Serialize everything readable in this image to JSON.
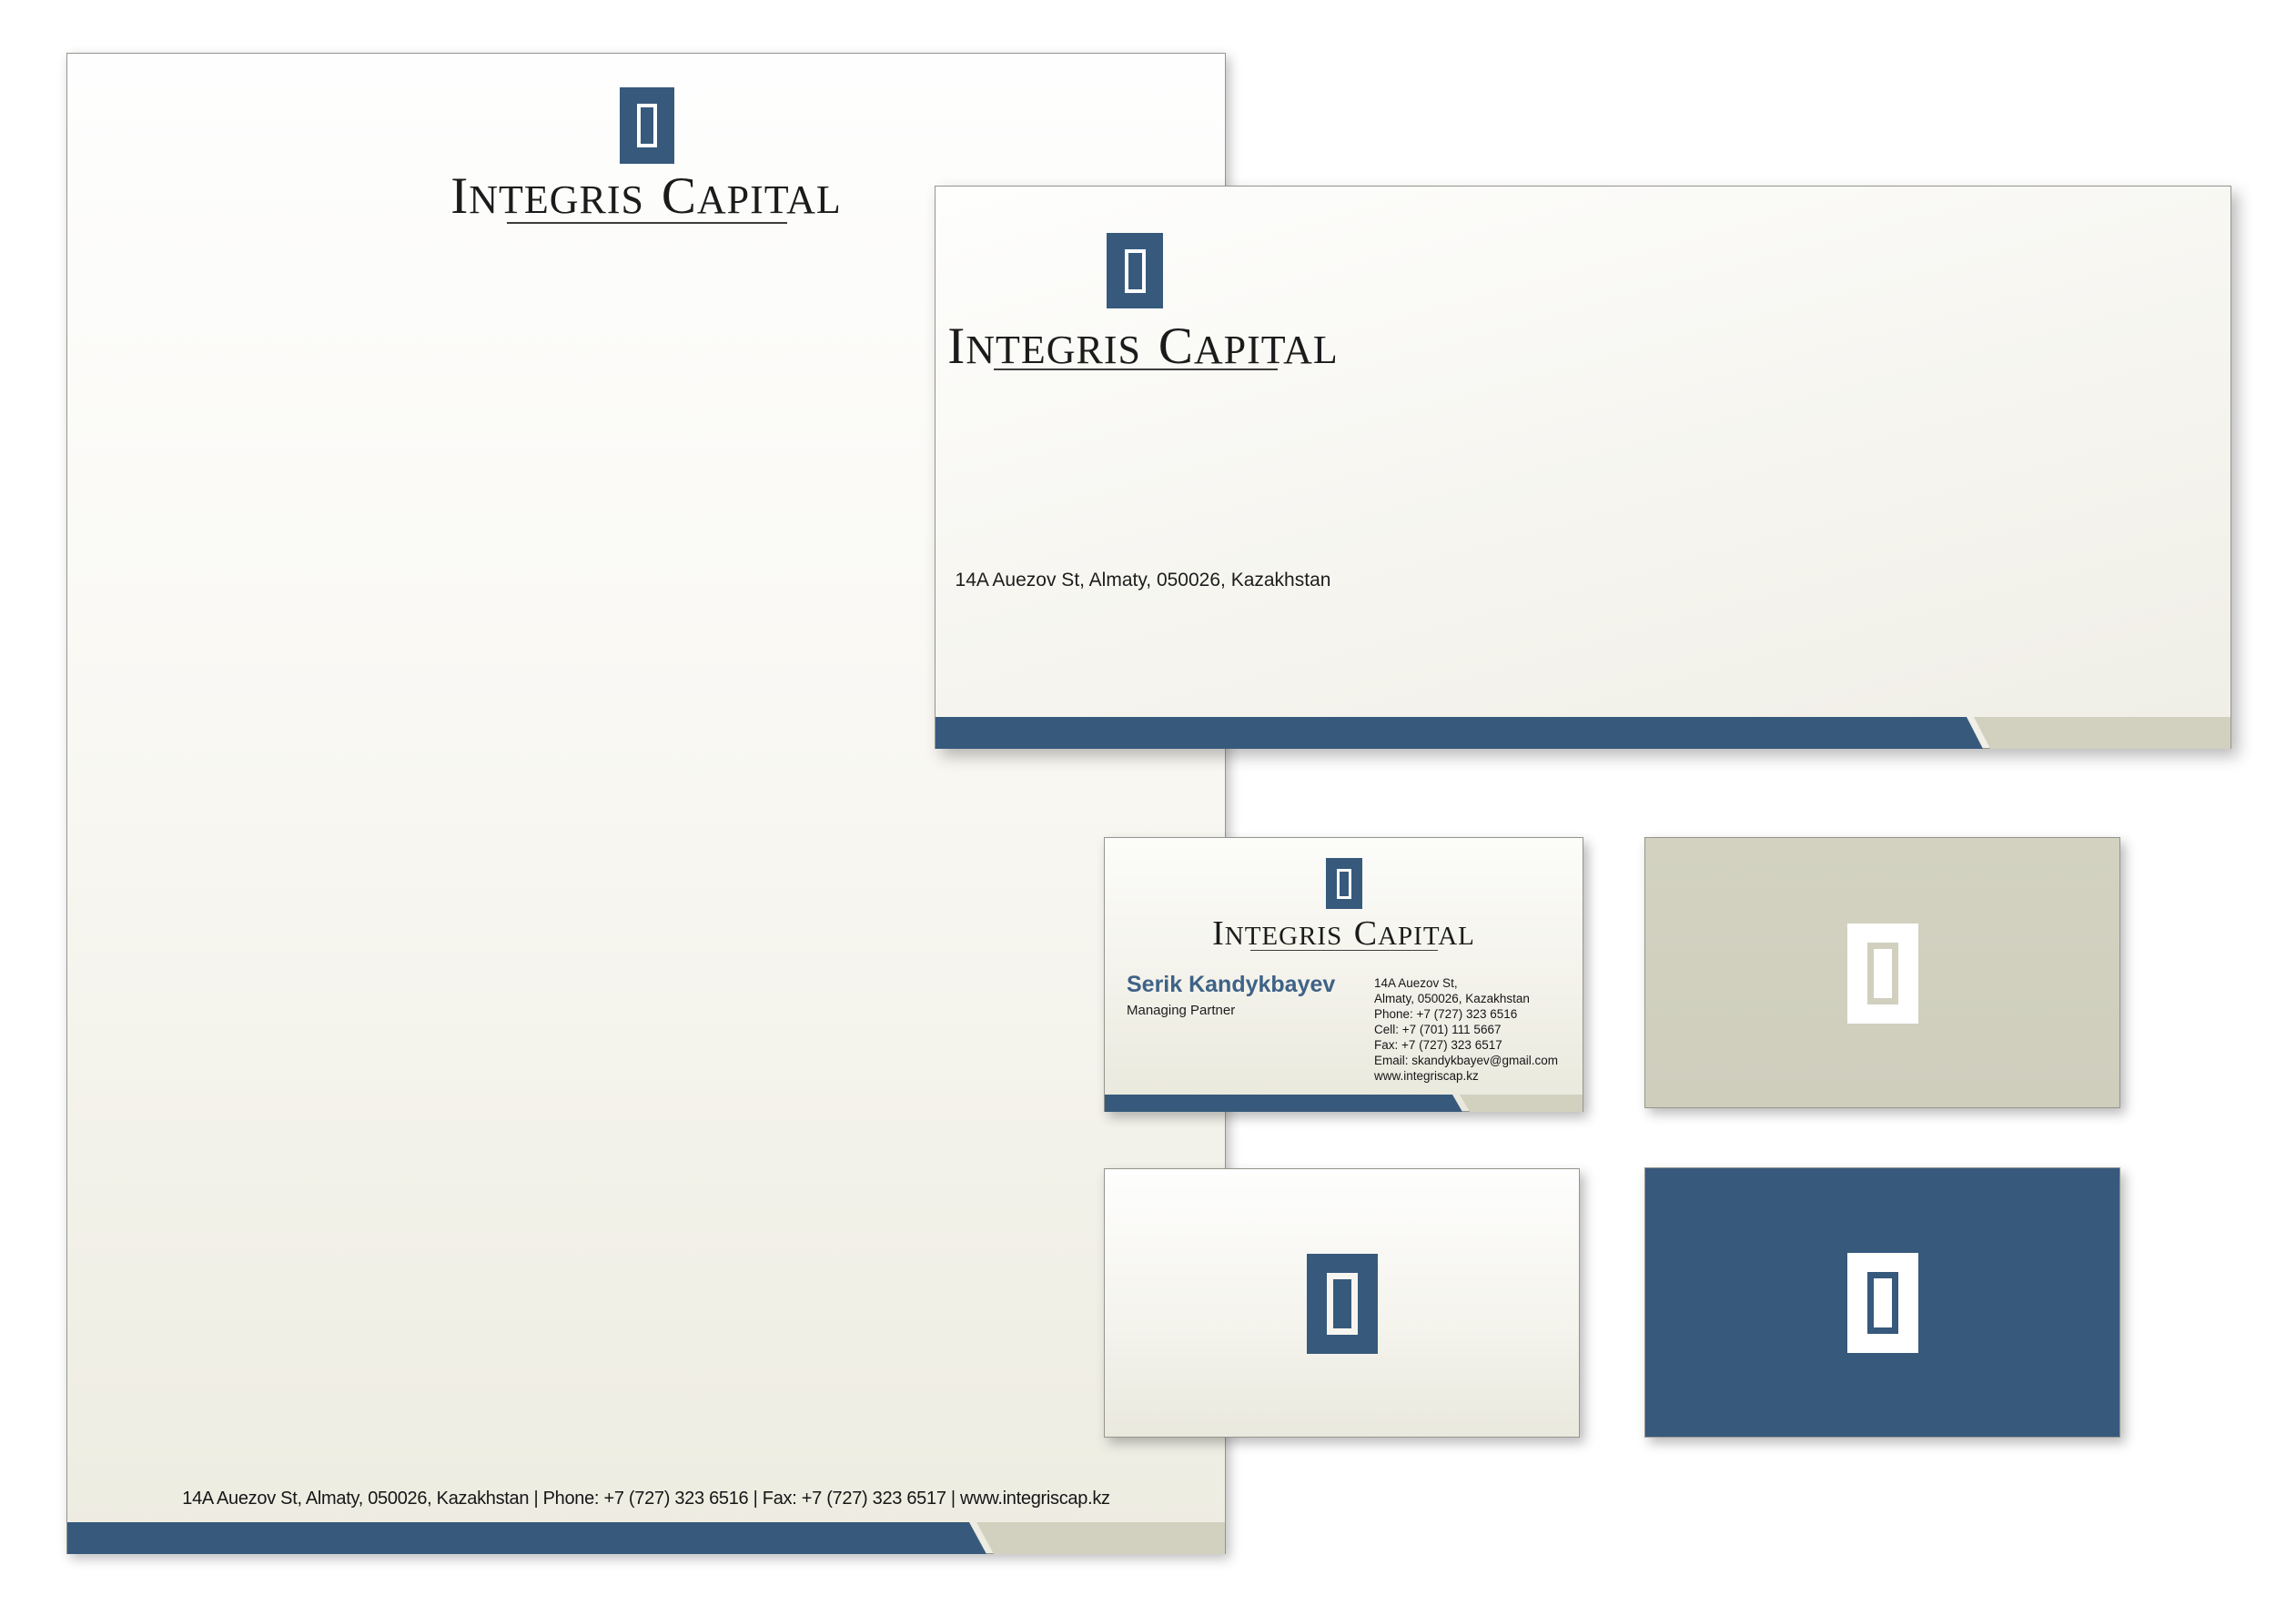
{
  "brand": {
    "name": "Integris Capital",
    "wordmark": {
      "w1i": "I",
      "w1r": "NTEGRIS",
      "w2i": "C",
      "w2r": "APITAL"
    },
    "colors": {
      "blue": "#375a7c",
      "beige": "#d2d1c0",
      "name_blue": "#3e6287",
      "text": "#1a1a1a"
    }
  },
  "letterhead": {
    "footer": "14A Auezov St, Almaty, 050026, Kazakhstan | Phone: +7 (727) 323 6516 | Fax: +7 (727) 323 6517 | www.integriscap.kz"
  },
  "envelope": {
    "address": "14A Auezov St, Almaty, 050026, Kazakhstan"
  },
  "business_card": {
    "person": {
      "name": "Serik Kandykbayev",
      "title": "Managing Partner"
    },
    "contact_lines": [
      "14A Auezov St,",
      "Almaty, 050026, Kazakhstan",
      "Phone: +7 (727) 323 6516",
      "Cell: +7 (701) 111 5667",
      "Fax: +7 (727) 323 6517",
      "Email: skandykbayev@gmail.com",
      "www.integriscap.kz"
    ]
  }
}
